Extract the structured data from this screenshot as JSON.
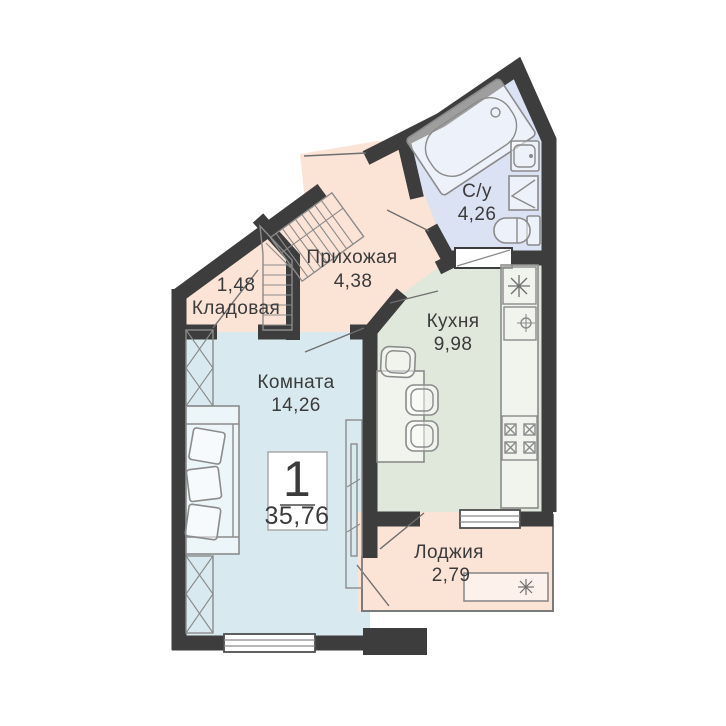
{
  "plan_title": "1-room apartment floor plan",
  "summary": {
    "rooms_count": "1",
    "total_area": "35,76"
  },
  "rooms": {
    "bathroom": {
      "name": "С/у",
      "area": "4,26"
    },
    "hallway": {
      "name": "Прихожая",
      "area": "4,38"
    },
    "storage": {
      "name": "Кладовая",
      "area": "1,48"
    },
    "kitchen": {
      "name": "Кухня",
      "area": "9,98"
    },
    "living": {
      "name": "Комната",
      "area": "14,26"
    },
    "loggia": {
      "name": "Лоджия",
      "area": "2,79"
    }
  },
  "colors": {
    "wall": "#3d3d3d",
    "hall_fill": "#fbe3d6",
    "bathroom_fill": "#dbe2f3",
    "kitchen_fill": "#e0e8db",
    "living_fill": "#d8eaf0",
    "loggia_fill": "#fbe3d6"
  }
}
